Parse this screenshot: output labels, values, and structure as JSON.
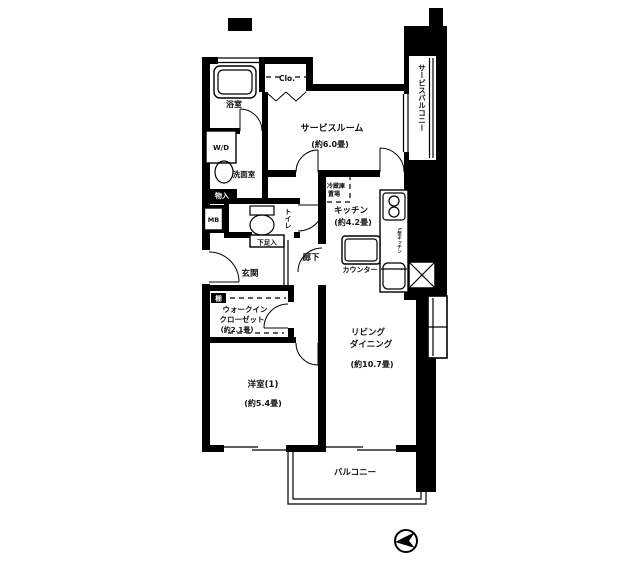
{
  "plan": {
    "rooms": {
      "service_room": {
        "name": "サービスルーム",
        "size": "(約6.0畳)"
      },
      "kitchen": {
        "name": "キッチン",
        "size": "(約4.2畳)"
      },
      "living_dining": {
        "line1": "リビング",
        "line2": "ダイニング",
        "size": "(約10.7畳)"
      },
      "bedroom": {
        "name": "洋室(1)",
        "size": "(約5.4畳)"
      },
      "walk_in_closet": {
        "line1": "ウォークイン",
        "line2": "クローゼット",
        "size": "(約2.1畳)"
      },
      "bathroom": {
        "name": "浴室"
      },
      "washroom": {
        "name": "洗面室"
      },
      "toilet": {
        "name": "トイレ"
      },
      "entrance": {
        "name": "玄関"
      },
      "hallway": {
        "name": "廊下"
      },
      "balcony": {
        "name": "バルコニー"
      },
      "service_balcony": {
        "name": "サービスバルコニー"
      }
    },
    "fixtures": {
      "closet": "Clo.",
      "washer_dryer": "W/D",
      "meter_box": "MB",
      "storage": "物入",
      "shoe_cabinet": "下足入",
      "refrigerator_line1": "冷蔵庫",
      "refrigerator_line2": "置場",
      "counter": "カウンター",
      "shelf": "棚",
      "kitchen_unit": "L型キッチン"
    },
    "colors": {
      "line": "#000000",
      "background": "#ffffff"
    }
  }
}
